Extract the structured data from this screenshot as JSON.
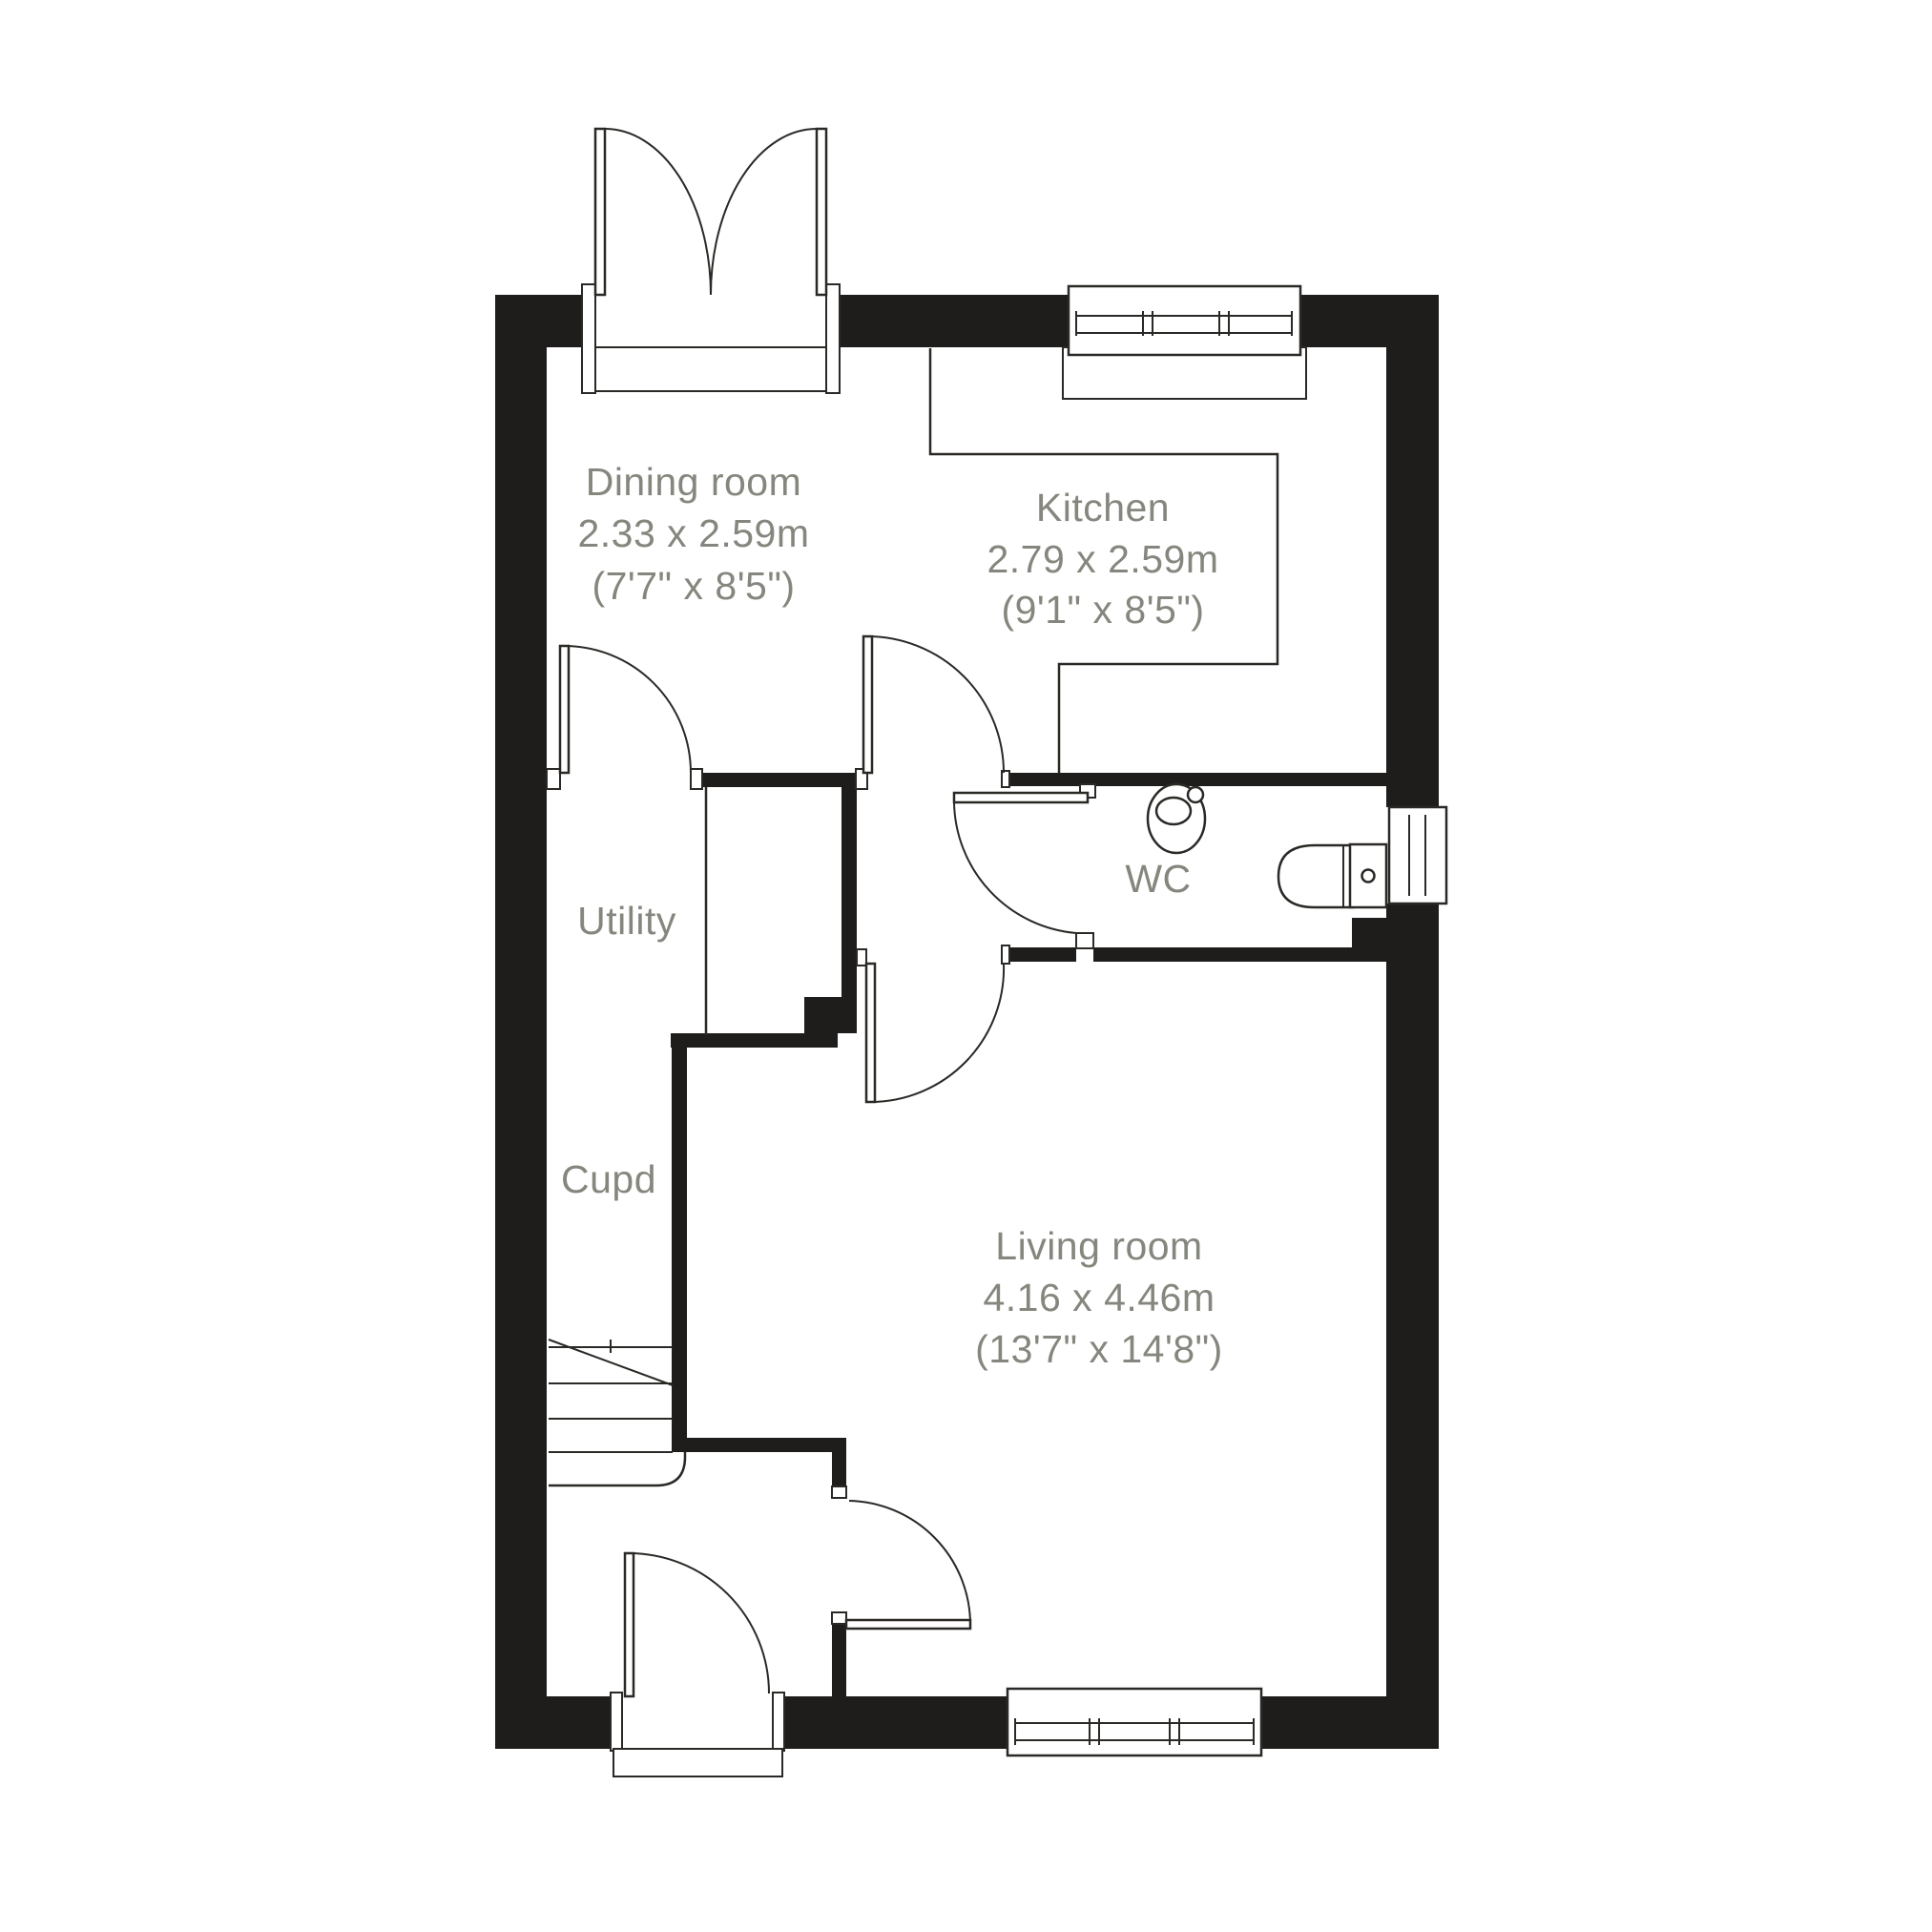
{
  "plan": {
    "type": "ground-floor-plan",
    "colors": {
      "wall": "#1f1d1b",
      "line": "#2b2926",
      "label_text": "#84877d",
      "background": "#ffffff"
    },
    "rooms": {
      "dining": {
        "name": "Dining room",
        "metric": "2.33 x 2.59m",
        "imperial": "(7'7\" x 8'5\")"
      },
      "kitchen": {
        "name": "Kitchen",
        "metric": "2.79 x 2.59m",
        "imperial": "(9'1\" x 8'5\")"
      },
      "utility": {
        "name": "Utility"
      },
      "cupd": {
        "name": "Cupd"
      },
      "wc": {
        "name": "WC"
      },
      "living": {
        "name": "Living room",
        "metric": "4.16 x 4.46m",
        "imperial": "(13'7\" x 14'8\")"
      }
    }
  }
}
